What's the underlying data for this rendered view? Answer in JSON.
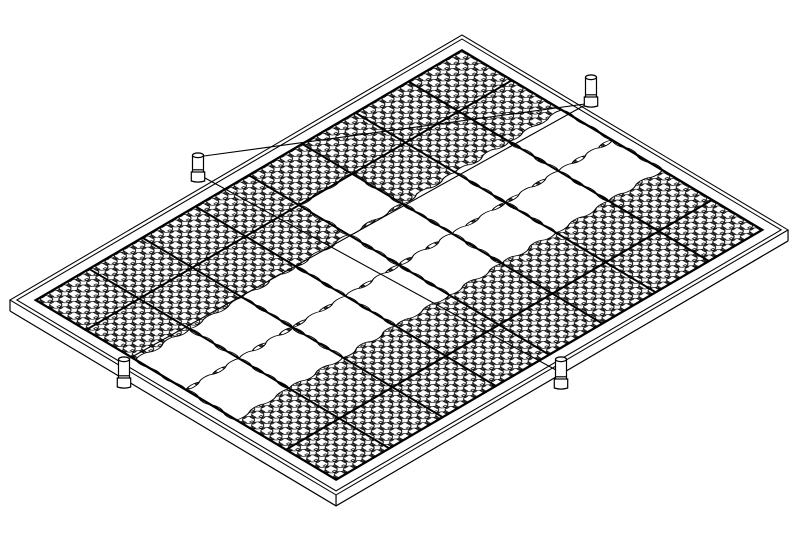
{
  "figure": {
    "title": "Isometric line drawing of a modular ground panel assembly with perforated grid tiles, blank interlocking tiles, frame rim, anchor pegs and tension strings",
    "background_color": "#ffffff",
    "line_color": "#000000"
  },
  "projection": {
    "origin": [
      462,
      35
    ],
    "axis_u": [
      0.858,
      0.513
    ],
    "axis_v": [
      -0.8626,
      0.5057
    ]
  },
  "frame": {
    "outer_rect": [
      0,
      0,
      380,
      524
    ],
    "outer_rect2": [
      4,
      4,
      372,
      516
    ],
    "inner_rect": [
      15,
      15,
      350,
      494
    ],
    "thickness_offset": 11,
    "thin_stroke": 1.2,
    "bold_stroke": 2.6
  },
  "grid": {
    "rows": 6,
    "cols": 8,
    "a0": 15,
    "b0": 15,
    "tile_a": 58.333,
    "tile_b": 61.75,
    "thick_col_boundaries": [
      1,
      2,
      3,
      4,
      5,
      6,
      7
    ],
    "thick_row_boundaries": [
      1,
      5
    ],
    "thick_stroke": 2.2
  },
  "pattern": {
    "cell": 10.7,
    "circle_r": 4.95,
    "connector_long": 2.0,
    "connector_wide": 2.5,
    "stroke": 0.8
  },
  "blank_tiles": [
    [
      2,
      0
    ],
    [
      2,
      1
    ],
    [
      2,
      2
    ],
    [
      2,
      3
    ],
    [
      2,
      4
    ],
    [
      2,
      5
    ],
    [
      2,
      6
    ],
    [
      2,
      7
    ],
    [
      3,
      0
    ],
    [
      3,
      1
    ],
    [
      3,
      2
    ],
    [
      3,
      3
    ],
    [
      3,
      4
    ],
    [
      3,
      5
    ],
    [
      3,
      6
    ],
    [
      3,
      7
    ],
    [
      1,
      3
    ]
  ],
  "blank_edge": {
    "segments": 4,
    "amplitudes": [
      2.6,
      -2.3,
      2.1,
      -2.7,
      2.4,
      -2.0
    ],
    "stroke": 1.0
  },
  "pegs": [
    {
      "cx": 591,
      "top": 75,
      "base": 106,
      "r": 5.5
    },
    {
      "cx": 198,
      "top": 153,
      "base": 181,
      "r": 5.5
    },
    {
      "cx": 124,
      "top": 357,
      "base": 387,
      "r": 5.5
    },
    {
      "cx": 561,
      "top": 357,
      "base": 388,
      "r": 5.5
    }
  ],
  "peg_style": {
    "sleeve_extra": 1.2,
    "sleeve_h": 9,
    "collar_gap": 2.2,
    "top_ry": 2.3,
    "stroke": 1.2
  },
  "strings": [
    {
      "x1": 585,
      "y1": 104,
      "x2": 204,
      "y2": 156
    },
    {
      "x1": 205,
      "y1": 178,
      "x2": 556,
      "y2": 370
    },
    {
      "x1": 130,
      "y1": 358,
      "x2": 585,
      "y2": 105
    }
  ],
  "string_stroke": 1.1
}
